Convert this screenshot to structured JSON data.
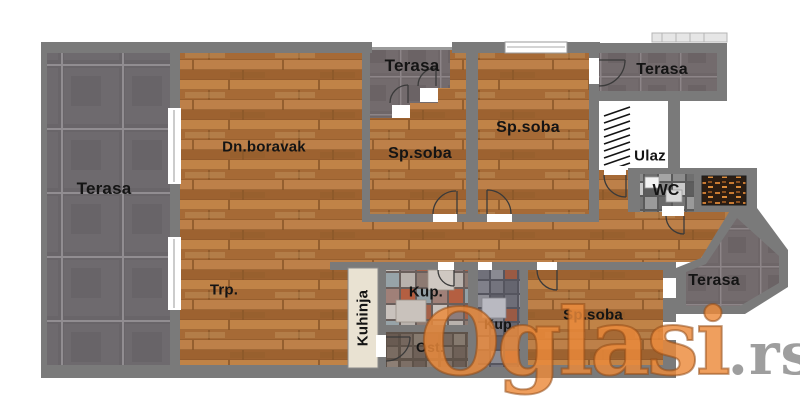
{
  "watermark": {
    "brand": "Oglasi",
    "tld": ".rs"
  },
  "rooms": {
    "terasa_left": {
      "label": "Terasa"
    },
    "dn_boravak": {
      "label": "Dn.boravak"
    },
    "terasa_mid": {
      "label": "Terasa"
    },
    "sp_soba_mid": {
      "label": "Sp.soba"
    },
    "sp_soba_right": {
      "label": "Sp.soba"
    },
    "terasa_top_right": {
      "label": "Terasa"
    },
    "ulaz": {
      "label": "Ulaz"
    },
    "wc": {
      "label": "WC"
    },
    "trpezarija": {
      "label": "Trp."
    },
    "kuhinja": {
      "label": "Kuhinja"
    },
    "kupatilo_1": {
      "label": "Kup."
    },
    "ostava": {
      "label": "Ost."
    },
    "kupatilo_2": {
      "label": "Kup."
    },
    "sp_soba_bottom": {
      "label": "Sp.soba"
    },
    "terasa_bottom_right": {
      "label": "Terasa"
    }
  },
  "colors": {
    "wall": "#7a7a7a",
    "wood": "#b5773f",
    "terrace_tile": "#696569",
    "kitchen_counter": "#e9e2d2",
    "watermark_orange": "#eb8a3a",
    "watermark_gray": "#949494",
    "label_text": "#141414"
  }
}
